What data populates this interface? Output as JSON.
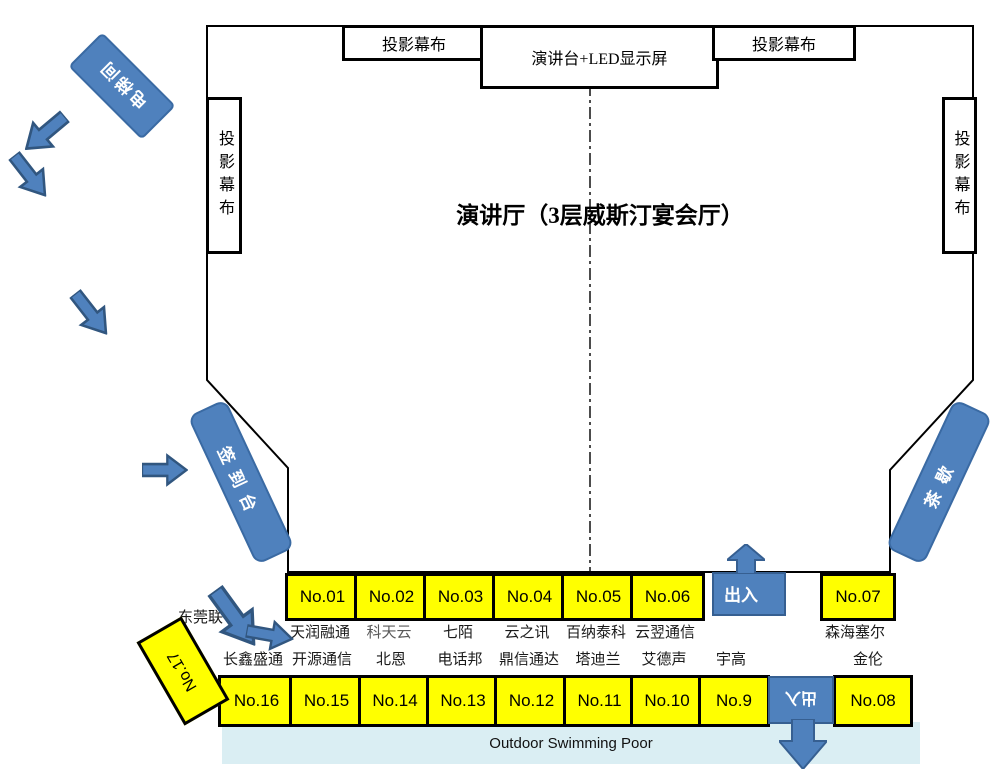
{
  "colors": {
    "accent_blue": "#4f81bd",
    "accent_border": "#365f91",
    "booth_yellow": "#ffff00",
    "pool_blue": "#daeef3",
    "wall_black": "#000000"
  },
  "hall": {
    "title": "演讲厅（3层威斯汀宴会厅）"
  },
  "equipment": {
    "screen_top_left": "投影幕布",
    "screen_top_right": "投影幕布",
    "screen_side_left": "投影幕布",
    "screen_side_right": "投影幕布",
    "podium": "演讲台+LED显示屏"
  },
  "facilities": {
    "elevator": "电梯间",
    "signin_desk": "签到台",
    "tea_break": "茶歇",
    "gate_top": "出入",
    "gate_bottom": "出入",
    "pool": "Outdoor Swimming Poor",
    "partial_text": "东莞联"
  },
  "booths_row1": [
    {
      "no": "No.01",
      "company": "天润融通"
    },
    {
      "no": "No.02",
      "company": "科天云"
    },
    {
      "no": "No.03",
      "company": "七陌"
    },
    {
      "no": "No.04",
      "company": "云之讯"
    },
    {
      "no": "No.05",
      "company": "百纳泰科"
    },
    {
      "no": "No.06",
      "company": "云翌通信"
    },
    {
      "no": "No.07",
      "company": "森海塞尔"
    }
  ],
  "booths_row2": [
    {
      "no": "No.16",
      "company": "长鑫盛通"
    },
    {
      "no": "No.15",
      "company": "开源通信"
    },
    {
      "no": "No.14",
      "company": "北恩"
    },
    {
      "no": "No.13",
      "company": "电话邦"
    },
    {
      "no": "No.12",
      "company": "鼎信通达"
    },
    {
      "no": "No.11",
      "company": "塔迪兰"
    },
    {
      "no": "No.10",
      "company": "艾德声"
    },
    {
      "no": "No.9",
      "company": "宇高"
    },
    {
      "no": "No.08",
      "company": "金伦"
    }
  ],
  "booth_corner": {
    "no": "No.17"
  }
}
